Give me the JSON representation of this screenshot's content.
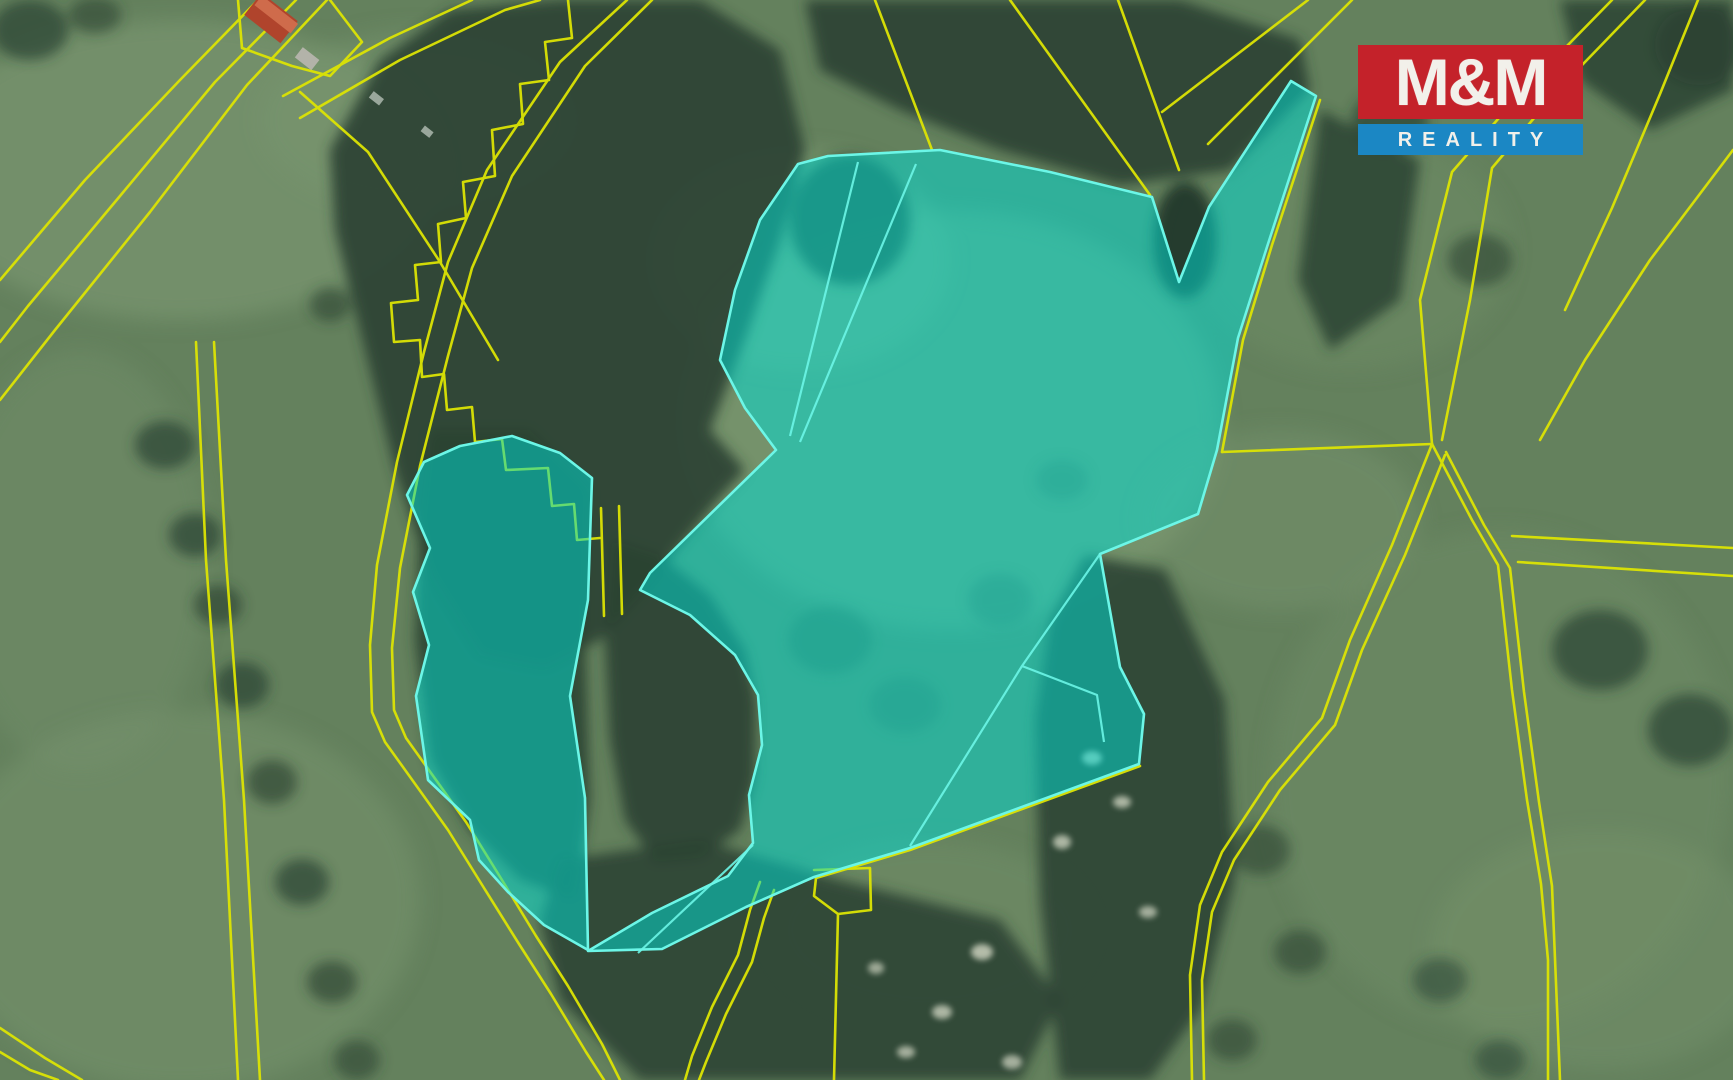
{
  "watermark": {
    "title": "M&M",
    "subtitle": "REALITY"
  },
  "theme": {
    "logo-red": "#c4222a",
    "logo-blue": "#1b87c4",
    "logo-text": "#f2f0ea",
    "parcel-fill": "#00ddd2",
    "parcel-stroke": "#6cf6e7",
    "cadastre-line": "#dde404",
    "field-green": "#64815d",
    "forest-green": "#2b4233"
  }
}
